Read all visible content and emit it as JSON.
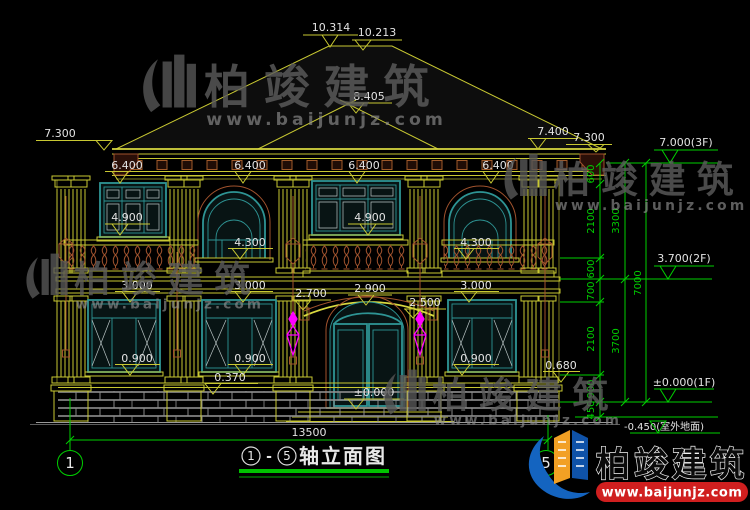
{
  "drawing_labels": {
    "ridge_a": "10.314",
    "ridge_b": "10.213",
    "porch_ridge": "8.405",
    "eave_left": "7.300",
    "eave_right_outer": "7.400",
    "eave_right": "7.300",
    "win2f_head": "6.400",
    "win2f_sill": "4.900",
    "arch2f_sill": "4.300",
    "win1f_head": "3.000",
    "win1f_sill": "0.900",
    "canopy_left": "2.700",
    "canopy_top": "2.900",
    "canopy_right": "2.500",
    "wall_base": "0.370",
    "pedestal_top": "0.680",
    "floor1_zero": "±0.000"
  },
  "right_markers": {
    "floor3": "7.000(3F)",
    "floor2": "3.700(2F)",
    "floor1": "±0.000(1F)",
    "ground": "-0.450(室外地面)"
  },
  "chain_dims": {
    "seg600": "600",
    "seg2100": "2100",
    "seg700": "700",
    "seg900": "900",
    "seg450": "450",
    "sum3300": "3300",
    "sum3700": "3700",
    "total": "7000",
    "width": "13500"
  },
  "title_block": {
    "axis_start": "1",
    "axis_end": "5",
    "separator": "-",
    "name": "轴立面图"
  },
  "axes": {
    "left": "1",
    "right": "5"
  },
  "watermark": {
    "brand": "柏竣建筑",
    "site": "www.baijunjz.com"
  },
  "logo": {
    "brand": "柏竣建筑",
    "site": "www.baijunjz.com"
  },
  "colors": {
    "line_yellow": "#c8c832",
    "window_teal": "#2e9494",
    "detail_brown": "#a0522d",
    "dim_green": "#00cf00",
    "lamp_magenta": "#ff00ff",
    "logo_red": "#d01f1f",
    "logo_blue": "#1464c0",
    "logo_orange": "#f2a024"
  }
}
